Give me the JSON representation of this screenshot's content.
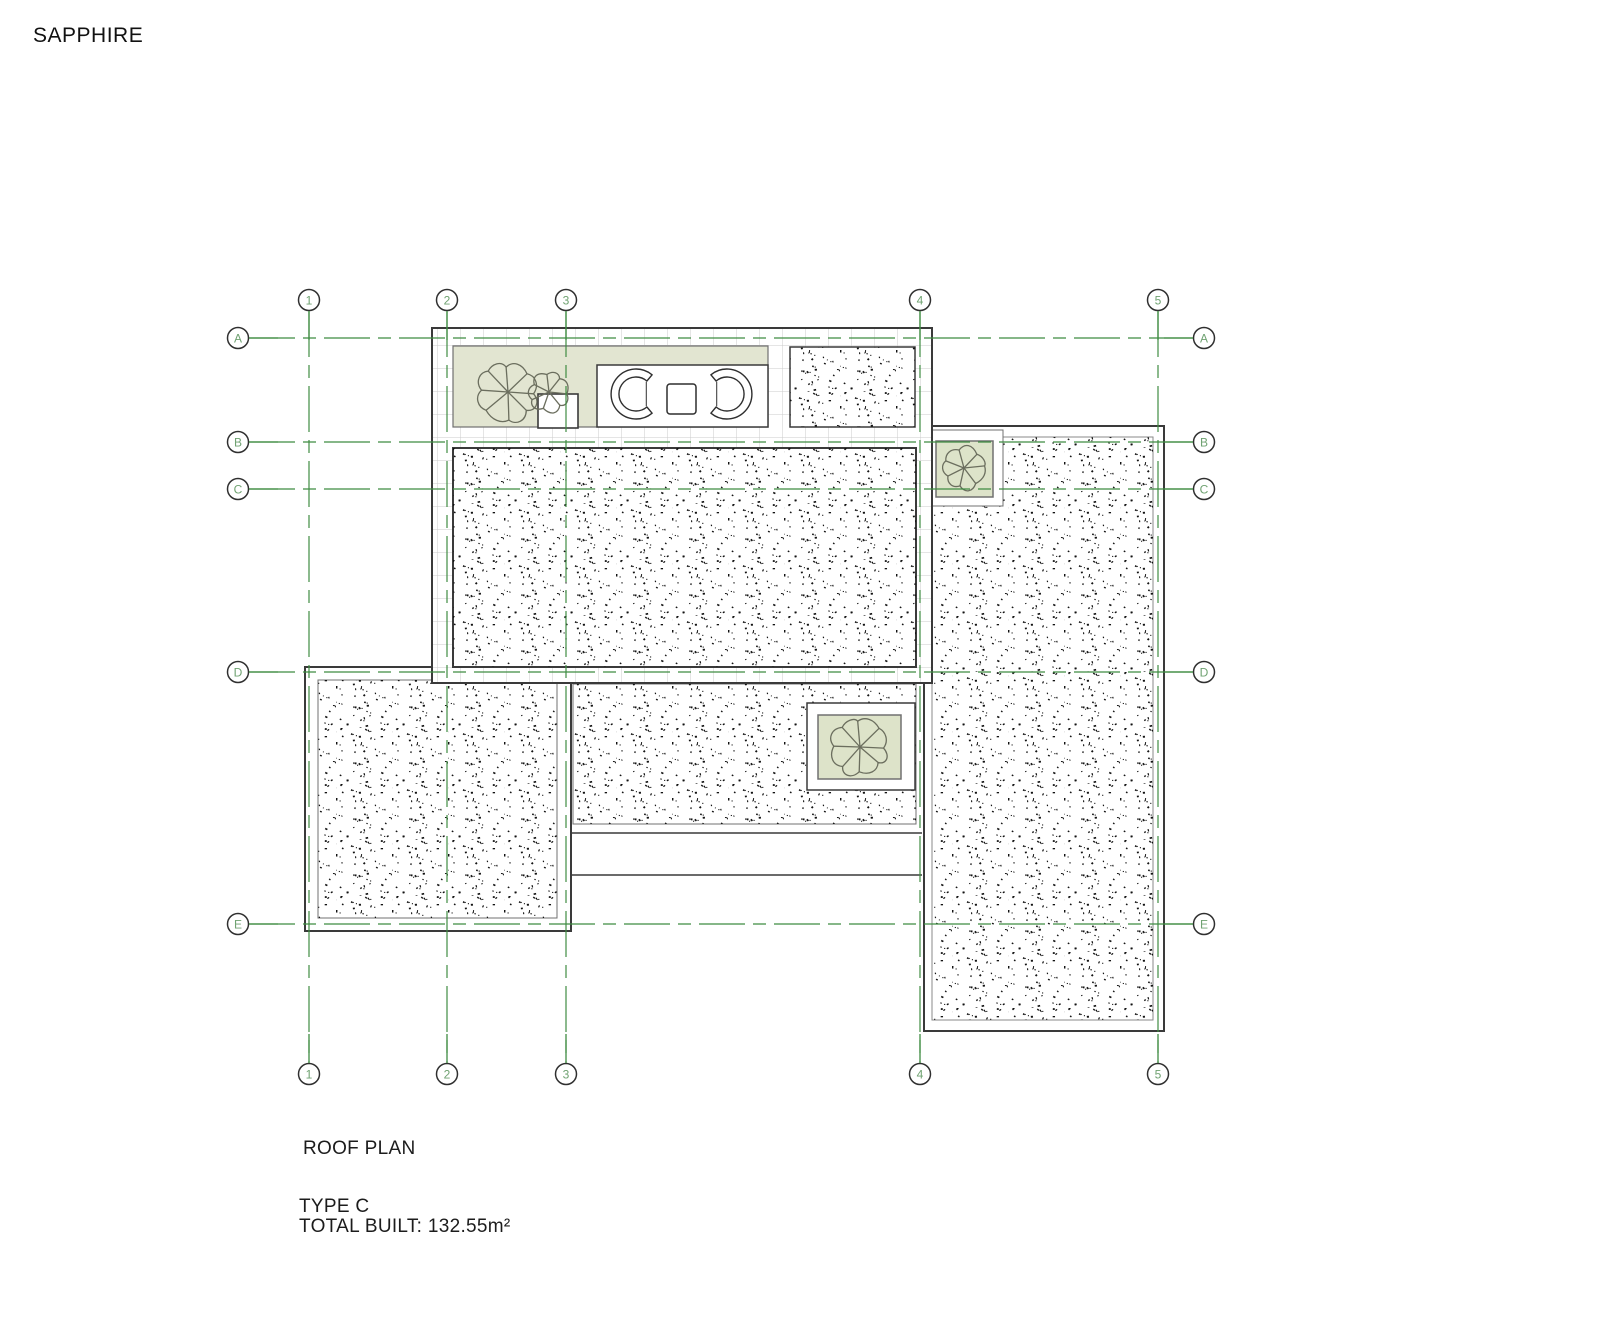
{
  "title": "SAPPHIRE",
  "plan": {
    "name": "ROOF PLAN",
    "type": "TYPE C",
    "total_built": "TOTAL BUILT: 132.55m²"
  },
  "grid": {
    "columns": [
      "1",
      "2",
      "3",
      "4",
      "5"
    ],
    "rows": [
      "A",
      "B",
      "C",
      "D",
      "E"
    ]
  },
  "colors": {
    "grid_green": "#3f8c42",
    "bubble_text_green": "#6fa271",
    "outline_dark": "#3a3a3a",
    "inner_line": "#707070",
    "tile_gray": "#cbcbcb",
    "terrace_fill": "#e2e5d1",
    "planter_fill": "#dde3c9",
    "tree_stroke": "#6b6e5e",
    "stipple_dark": "#121212",
    "bubble_stroke": "#2f2f2f"
  }
}
